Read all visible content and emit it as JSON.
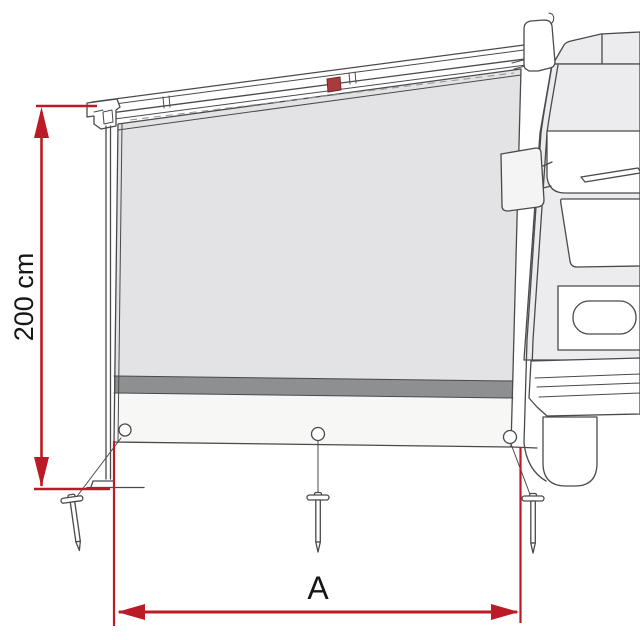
{
  "labels": {
    "height": "200 cm",
    "width": "A"
  },
  "colors": {
    "background": "#ffffff",
    "line": "#4a4a4d",
    "dimension_red": "#bb1b26",
    "roller_block_red": "#a93a3e",
    "panel_fabric": "#e3e3e5",
    "panel_band": "#8e8f91",
    "panel_skirt": "#f7f7f5",
    "vehicle_body": "#ececee"
  }
}
